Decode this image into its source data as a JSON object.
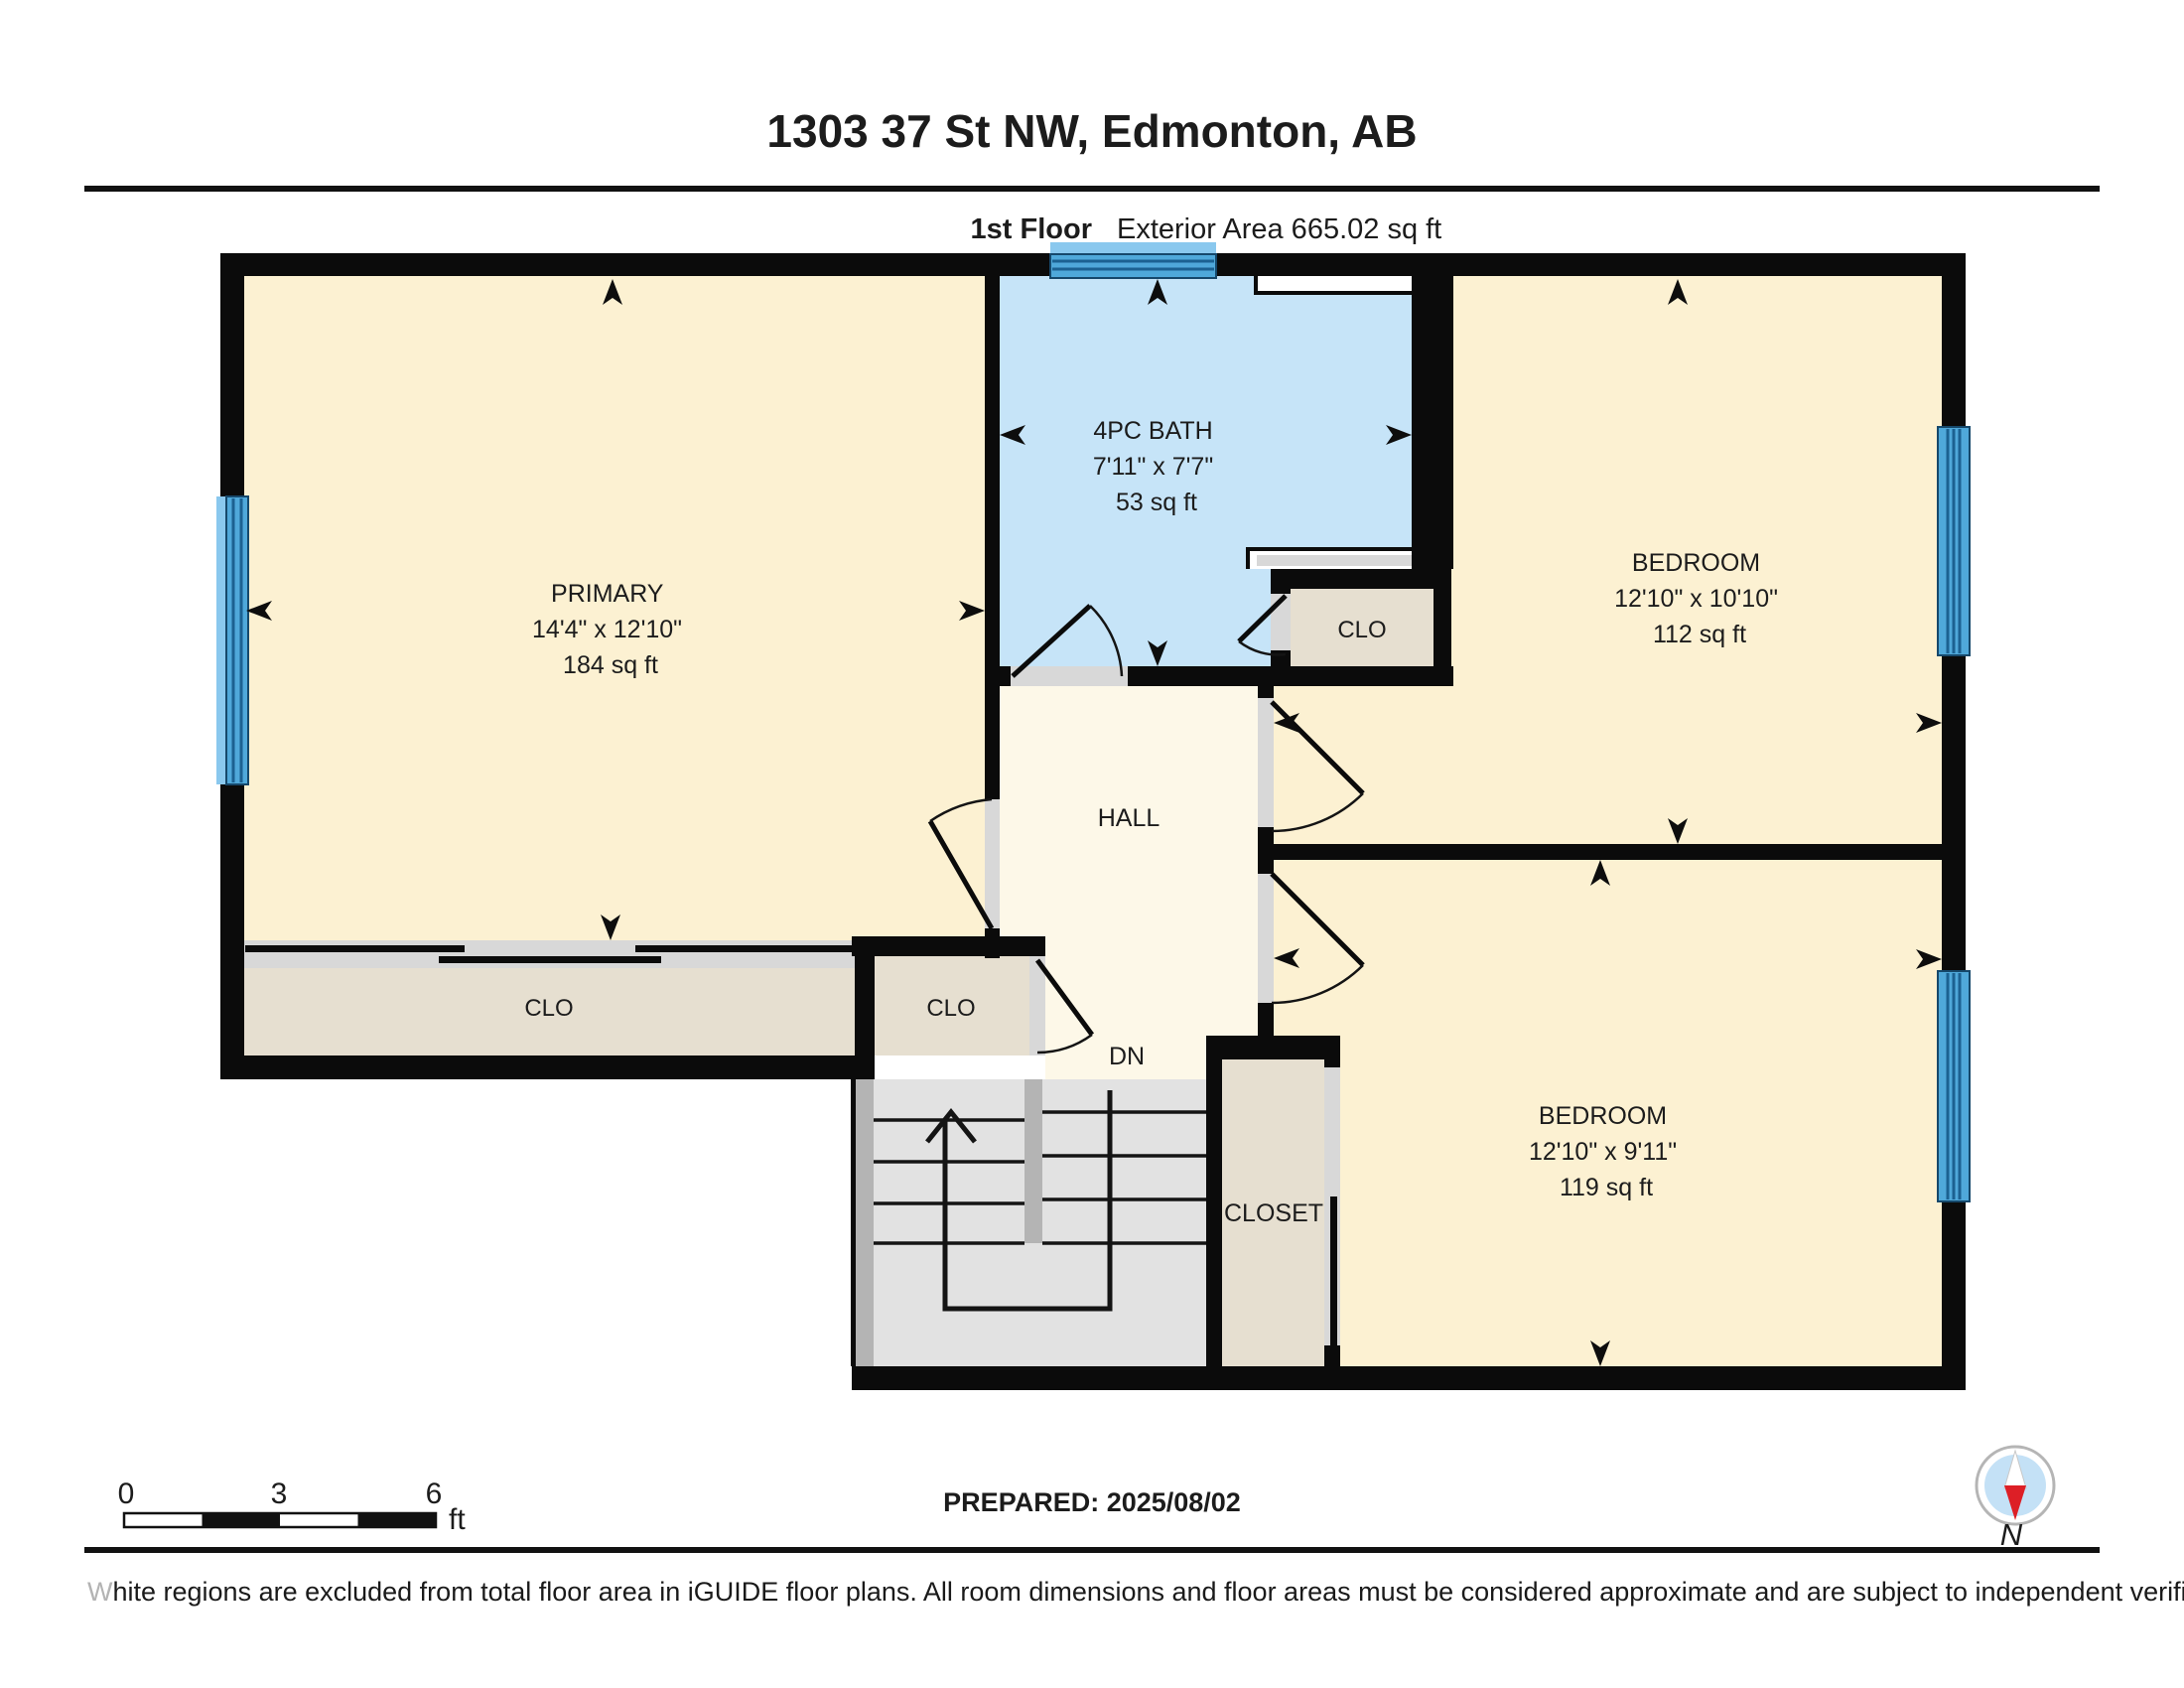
{
  "header": {
    "title": "1303 37 St NW, Edmonton, AB",
    "floor_label": "1st Floor",
    "exterior_area": "Exterior Area 665.02 sq ft",
    "interior_area": "Interior Area 617.93 sq ft"
  },
  "rooms": {
    "primary": {
      "name": "PRIMARY",
      "dims": "14'4\" x 12'10\"",
      "area": "184 sq ft"
    },
    "bath": {
      "name": "4PC BATH",
      "dims": "7'11\" x 7'7\"",
      "area": "53 sq ft"
    },
    "bedroom_top": {
      "name": "BEDROOM",
      "dims": "12'10\" x 10'10\"",
      "area": "112 sq ft"
    },
    "bedroom_bottom": {
      "name": "BEDROOM",
      "dims": "12'10\" x 9'11\"",
      "area": "119 sq ft"
    },
    "hall": {
      "name": "HALL"
    },
    "stairs": {
      "down_label": "DN"
    },
    "closet_primary": {
      "name": "CLO"
    },
    "closet_hall": {
      "name": "CLO"
    },
    "closet_bath": {
      "name": "CLO"
    },
    "closet_bedroom": {
      "name": "CLOSET"
    }
  },
  "scale_bar": {
    "ticks": [
      "0",
      "3",
      "6"
    ],
    "unit": "ft"
  },
  "footer": {
    "prepared": "PREPARED: 2025/08/02",
    "disclaimer_lead": "W",
    "disclaimer_rest": "hite regions are excluded from total floor area in iGUIDE floor plans. All room dimensions and floor areas must be considered approximate and are subject to independent verification.",
    "compass_north": "N"
  },
  "colors": {
    "wall": "#0b0b0b",
    "room_fill": "#fcf1d2",
    "hall_fill": "#fdf8e8",
    "closet_fill": "#e6dfd0",
    "bath_fill": "#c6e4f8",
    "window_main": "#4fa8da",
    "window_light": "#8ac8ee",
    "window_line": "#1c6191",
    "stair_fill": "#e2e2e2",
    "stair_edge": "#b4b4b4",
    "door_jamb": "#d8d8d8",
    "niche_gray": "#d8d8d8",
    "compass_red": "#dd1f26",
    "compass_blue": "#c4e1f6",
    "compass_ring": "#b5b5b5"
  }
}
